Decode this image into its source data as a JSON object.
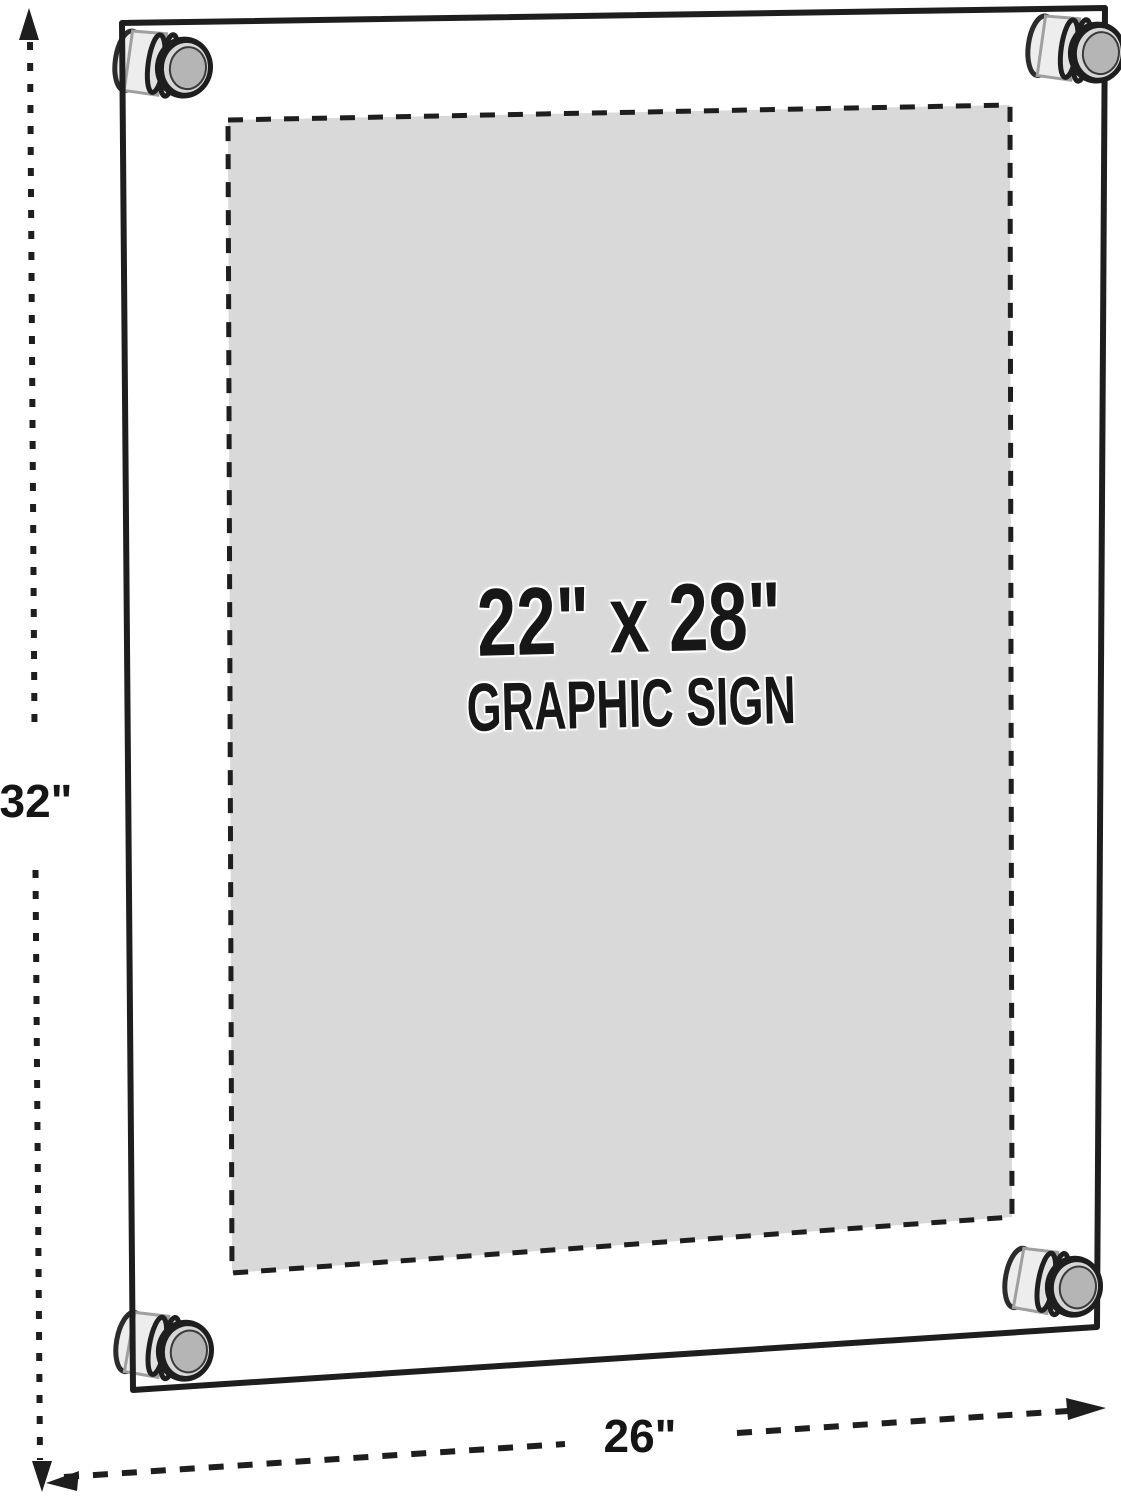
{
  "sign": {
    "line1": "22\" x 28\"",
    "line2": "GRAPHIC SIGN"
  },
  "dimensions": {
    "height_label": "32\"",
    "width_label": "26\""
  },
  "icons": {
    "arrows": [
      "arrow-up-icon",
      "arrow-down-icon",
      "arrow-left-icon",
      "arrow-right-icon"
    ]
  },
  "colors": {
    "line": "#1e1e1e",
    "sign_fill": "#d9d9d9",
    "standoff_face": "#b5b5b5",
    "standoff_body": "#ededed",
    "background": "#ffffff"
  }
}
